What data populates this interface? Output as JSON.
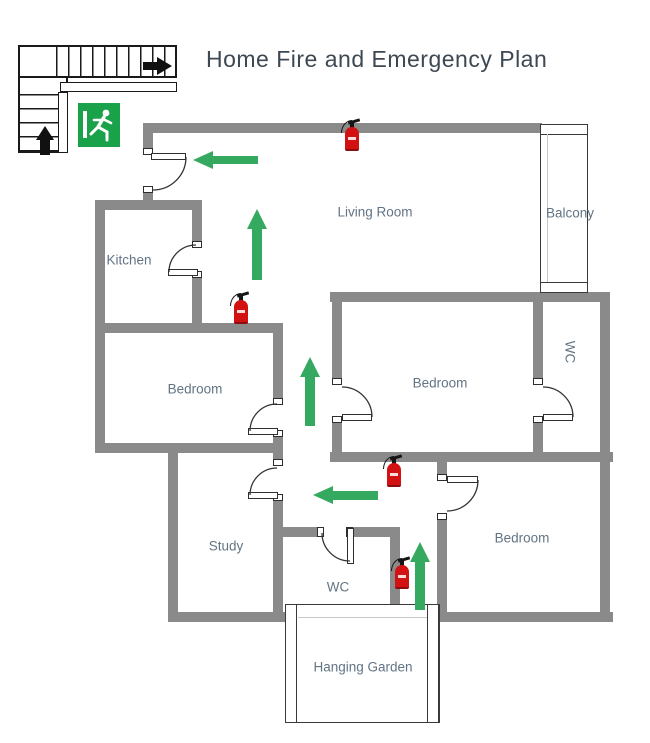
{
  "title": "Home Fire and Emergency Plan",
  "colors": {
    "wall": "#8a8a8a",
    "arrow": "#35a95f",
    "exit": "#1aa24b",
    "ext": "#d21212",
    "label": "#627484",
    "title": "#3e4852"
  },
  "rooms": {
    "living_room": {
      "label": "Living Room"
    },
    "balcony": {
      "label": "Balcony"
    },
    "kitchen": {
      "label": "Kitchen"
    },
    "bedroom_left": {
      "label": "Bedroom"
    },
    "bedroom_middle": {
      "label": "Bedroom"
    },
    "bedroom_right": {
      "label": "Bedroom"
    },
    "wc_upper": {
      "label": "WC"
    },
    "wc_lower": {
      "label": "WC"
    },
    "study": {
      "label": "Study"
    },
    "hanging_garden": {
      "label": "Hanging Garden"
    }
  },
  "icons": {
    "stairs": "stairs-icon",
    "emergency_exit": "emergency-exit-sign-icon",
    "fire_extinguisher": "fire-extinguisher-icon",
    "escape_route_arrow": "escape-route-arrow-icon"
  },
  "escape_route_arrows": [
    {
      "direction": "left",
      "area": "entrance-door"
    },
    {
      "direction": "up",
      "area": "upper-hallway"
    },
    {
      "direction": "up",
      "area": "middle-hallway"
    },
    {
      "direction": "left",
      "area": "lower-hallway"
    },
    {
      "direction": "up",
      "area": "garden-corridor"
    }
  ],
  "fire_extinguishers": [
    {
      "location": "living-room-top-wall"
    },
    {
      "location": "upper-hallway"
    },
    {
      "location": "lower-hallway"
    },
    {
      "location": "wc-corridor"
    }
  ]
}
